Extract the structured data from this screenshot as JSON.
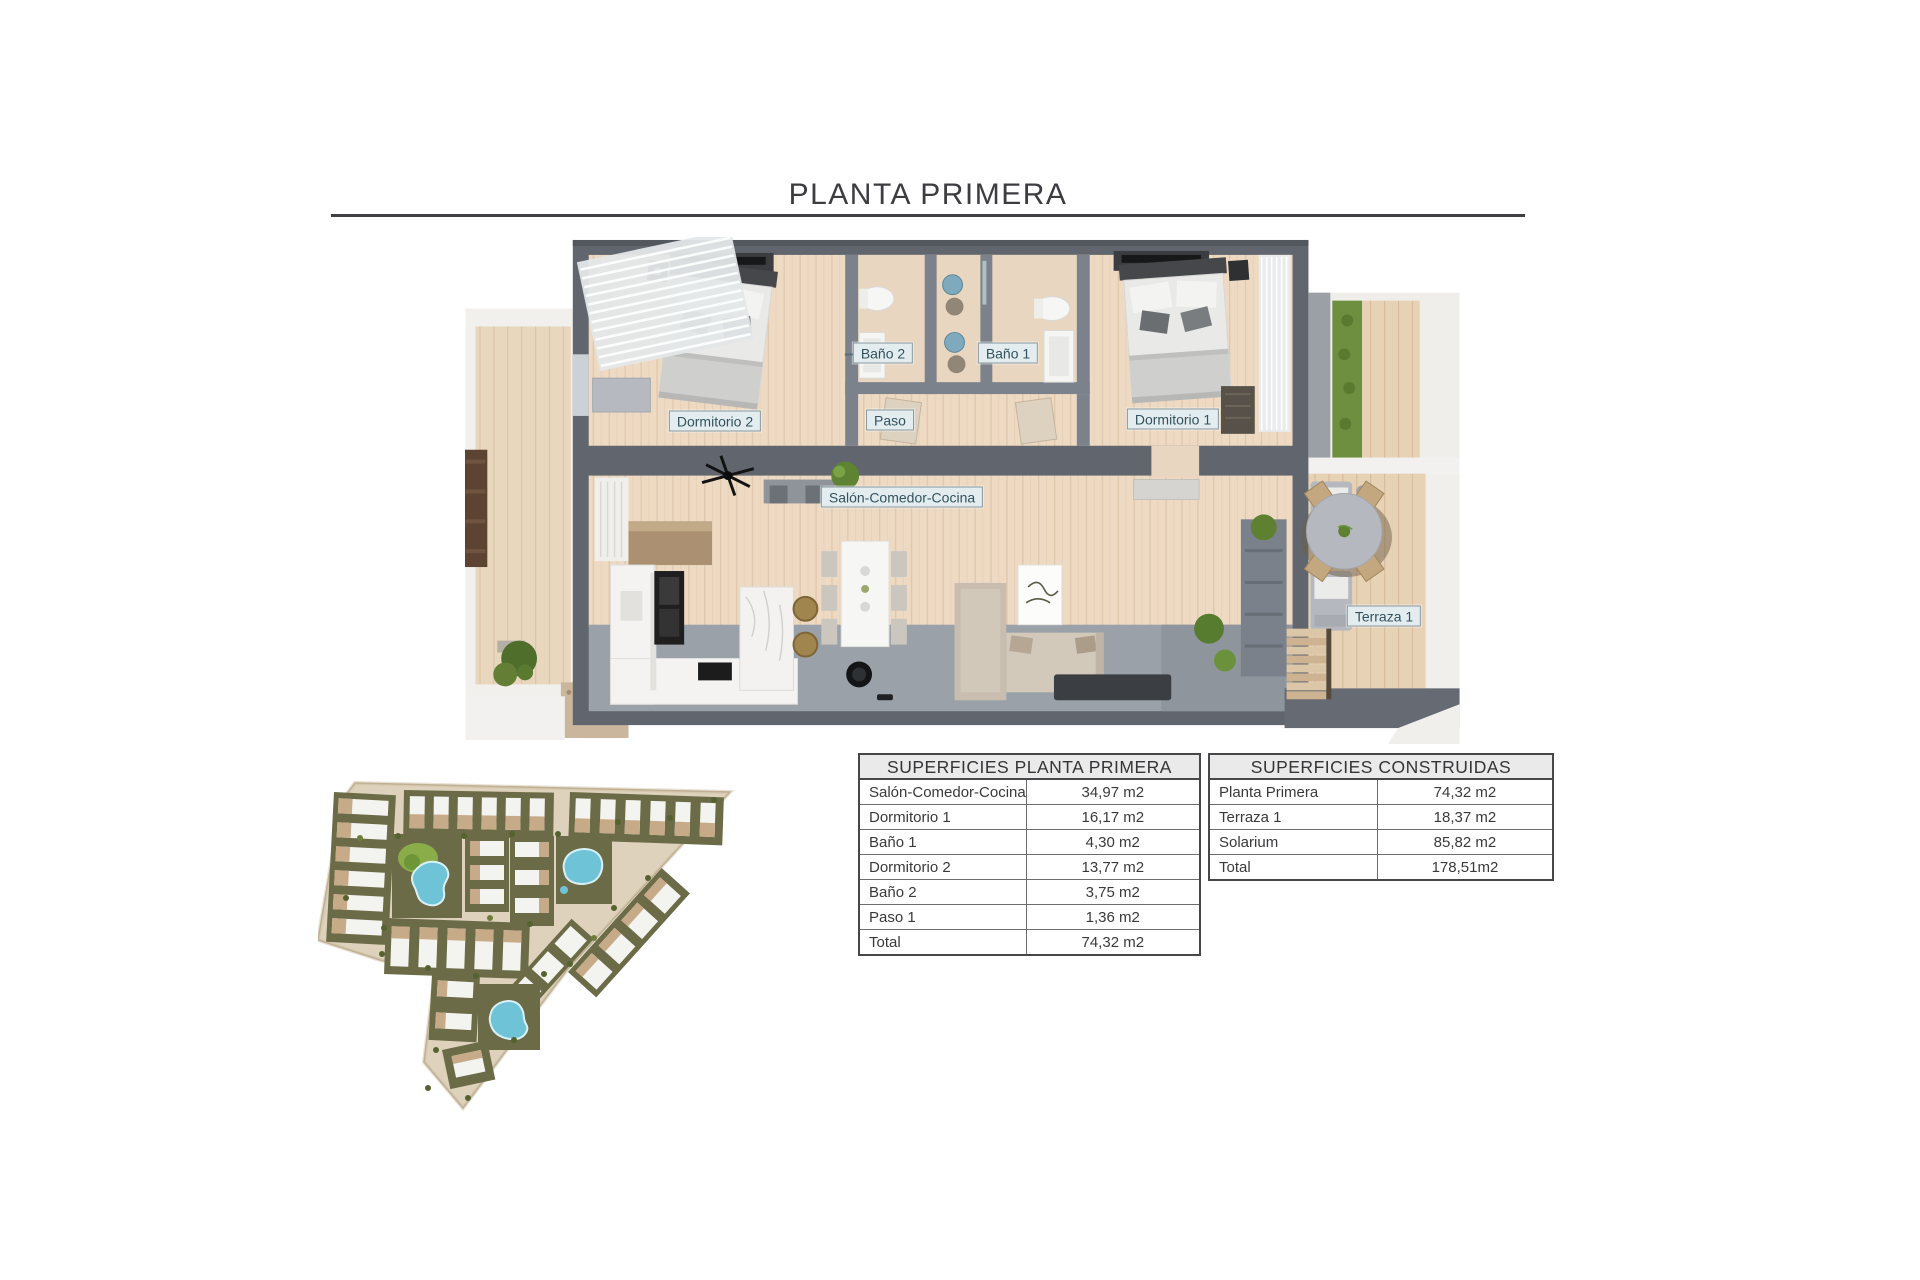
{
  "page": {
    "title": "PLANTA PRIMERA"
  },
  "colors": {
    "title_text": "#3d3d41",
    "rule": "#3f3f44",
    "wall_gray": "#61666e",
    "inner_wall_gray": "#7c828c",
    "wood_floor": "#eedac3",
    "deck_wood": "#e8d2b5",
    "concrete_floor": "#9ba1a9",
    "room_label_bg": "#e3edf0",
    "room_label_border": "#87989f",
    "room_label_text": "#33525d",
    "table_header_bg": "#eaeaea",
    "table_border": "#47474a",
    "table_text": "#3a3a3c",
    "site_base_beige": "#ded2bc",
    "site_block_olive": "#6b6b47",
    "pool_blue": "#6fc3d6",
    "lawn_green": "#8aad4a"
  },
  "floor_plan": {
    "labels": [
      {
        "id": "bano-2",
        "text": "Baño 2"
      },
      {
        "id": "bano-1",
        "text": "Baño 1"
      },
      {
        "id": "dormitorio-2",
        "text": "Dormitorio 2"
      },
      {
        "id": "paso",
        "text": "Paso"
      },
      {
        "id": "dormitorio-1",
        "text": "Dormitorio 1"
      },
      {
        "id": "salon-comedor-cocina",
        "text": "Salón-Comedor-Cocina"
      },
      {
        "id": "terraza-1",
        "text": "Terraza 1"
      }
    ]
  },
  "tables": [
    {
      "title": "SUPERFICIES PLANTA PRIMERA",
      "rows": [
        {
          "label": "Salón-Comedor-Cocina",
          "value": "34,97 m2"
        },
        {
          "label": "Dormitorio 1",
          "value": "16,17 m2"
        },
        {
          "label": "Baño 1",
          "value": "4,30 m2"
        },
        {
          "label": "Dormitorio 2",
          "value": "13,77 m2"
        },
        {
          "label": "Baño 2",
          "value": "3,75 m2"
        },
        {
          "label": "Paso 1",
          "value": "1,36 m2"
        },
        {
          "label": "Total",
          "value": "74,32 m2"
        }
      ]
    },
    {
      "title": "SUPERFICIES CONSTRUIDAS",
      "rows": [
        {
          "label": "Planta Primera",
          "value": "74,32 m2"
        },
        {
          "label": "Terraza 1",
          "value": "18,37 m2"
        },
        {
          "label": "Solarium",
          "value": "85,82 m2"
        },
        {
          "label": "Total",
          "value": "178,51m2"
        }
      ]
    }
  ]
}
